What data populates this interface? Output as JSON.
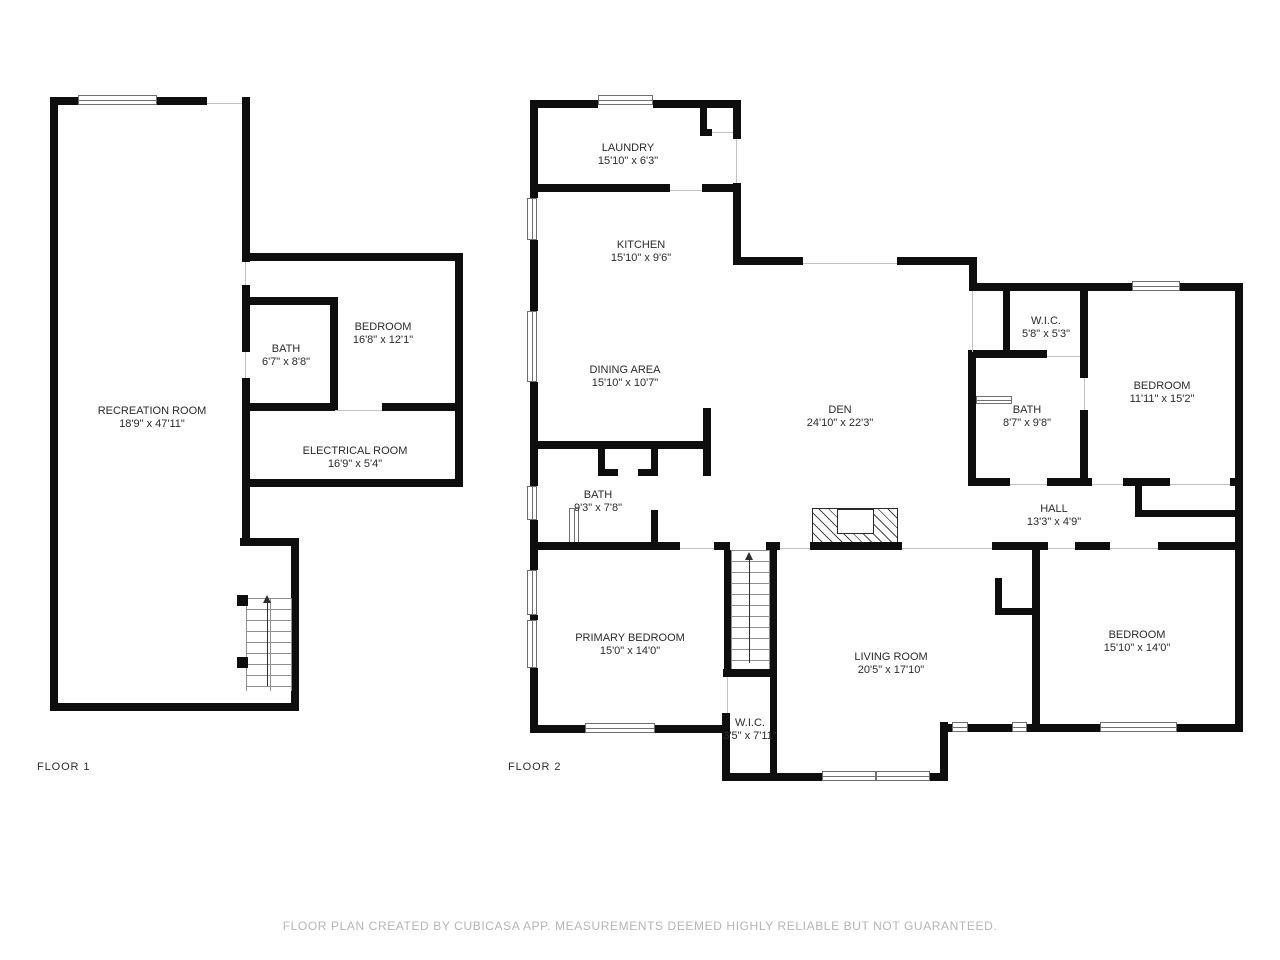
{
  "floor1": {
    "label": "FLOOR 1",
    "rooms": [
      {
        "name": "RECREATION ROOM",
        "dims": "18'9\" x 47'11\""
      },
      {
        "name": "BATH",
        "dims": "6'7\" x 8'8\""
      },
      {
        "name": "BEDROOM",
        "dims": "16'8\" x 12'1\""
      },
      {
        "name": "ELECTRICAL ROOM",
        "dims": "16'9\" x 5'4\""
      }
    ]
  },
  "floor2": {
    "label": "FLOOR 2",
    "rooms": [
      {
        "name": "LAUNDRY",
        "dims": "15'10\" x 6'3\""
      },
      {
        "name": "KITCHEN",
        "dims": "15'10\" x 9'6\""
      },
      {
        "name": "DINING AREA",
        "dims": "15'10\" x 10'7\""
      },
      {
        "name": "DEN",
        "dims": "24'10\" x 22'3\""
      },
      {
        "name": "W.I.C.",
        "dims": "5'8\" x 5'3\""
      },
      {
        "name": "BEDROOM",
        "dims": "11'11\" x 15'2\""
      },
      {
        "name": "BATH",
        "dims": "8'7\" x 9'8\""
      },
      {
        "name": "HALL",
        "dims": "13'3\" x 4'9\""
      },
      {
        "name": "BATH",
        "dims": "9'3\" x 7'8\""
      },
      {
        "name": "PRIMARY BEDROOM",
        "dims": "15'0\" x 14'0\""
      },
      {
        "name": "LIVING ROOM",
        "dims": "20'5\" x 17'10\""
      },
      {
        "name": "W.I.C.",
        "dims": "3'5\" x 7'11\""
      },
      {
        "name": "BEDROOM",
        "dims": "15'10\" x 14'0\""
      }
    ]
  },
  "footer": {
    "disclaimer": "FLOOR PLAN CREATED BY CUBICASA APP. MEASUREMENTS DEEMED HIGHLY RELIABLE BUT NOT GUARANTEED."
  },
  "colors": {
    "wall": "#0e0e0e",
    "text": "#2b2b2b",
    "disclaimer": "#b5b5b5",
    "background": "#ffffff"
  }
}
